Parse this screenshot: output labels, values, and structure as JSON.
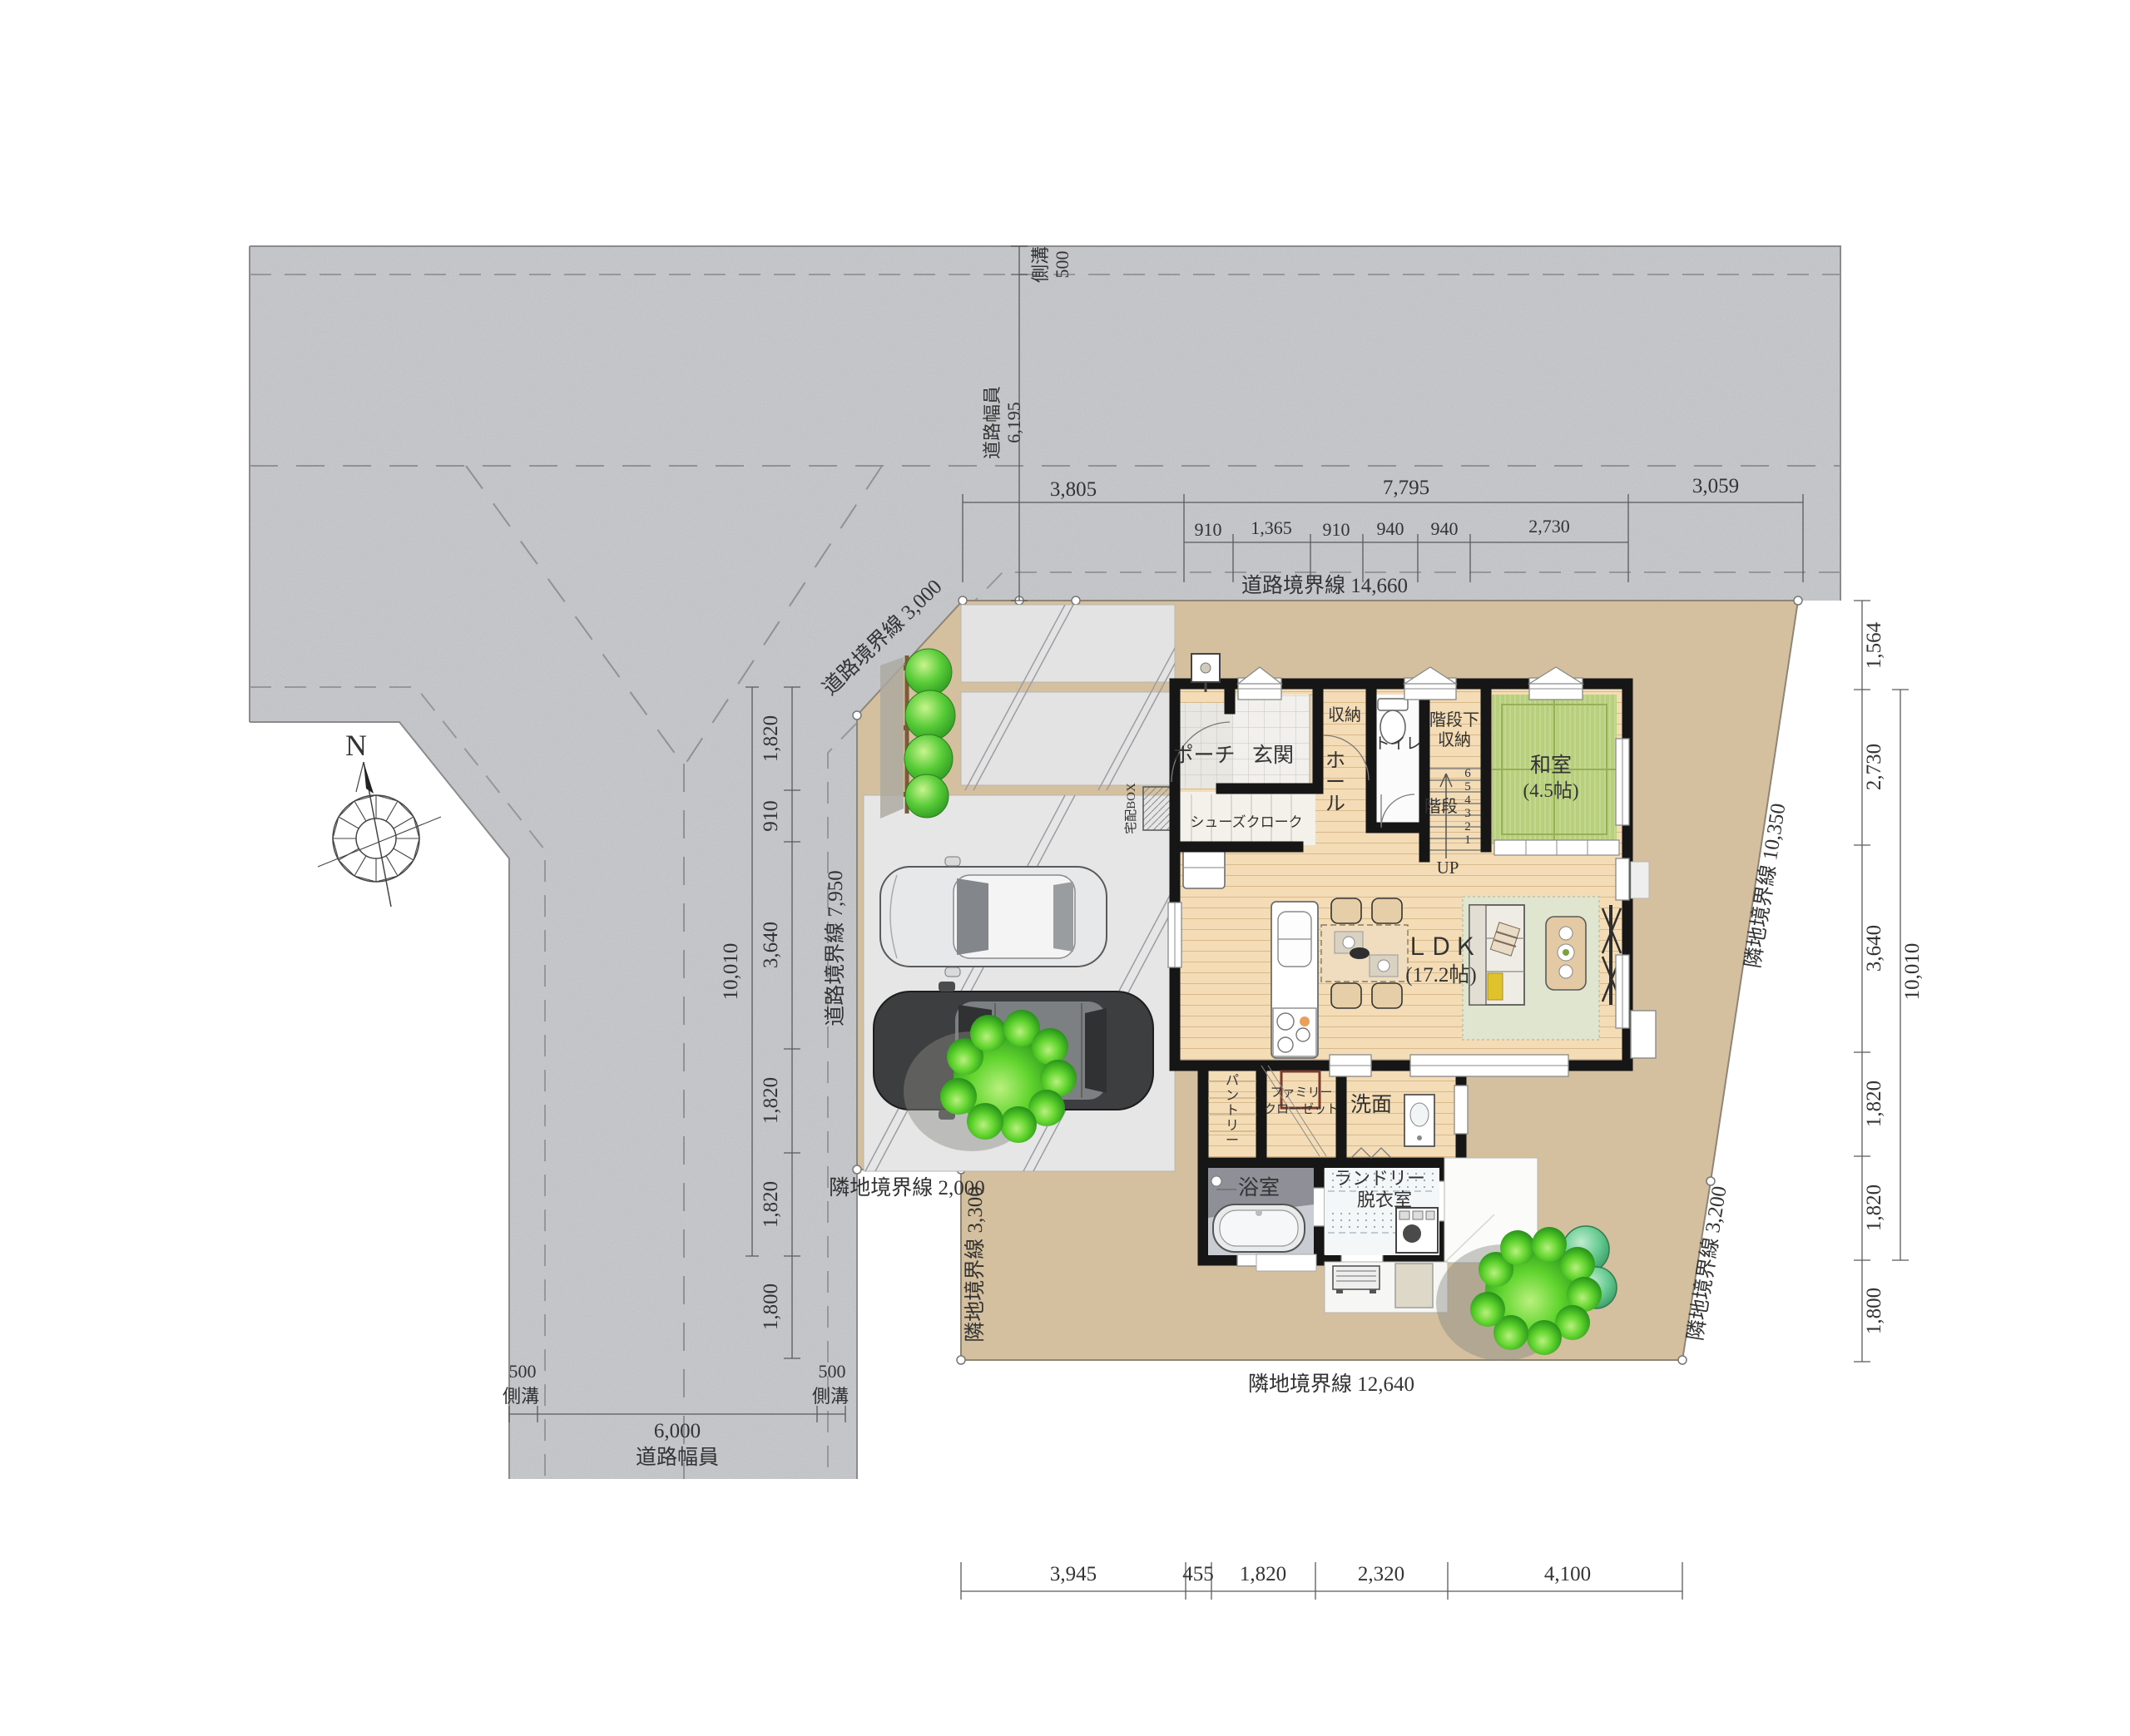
{
  "drawing": {
    "type": "residential site plan"
  },
  "compass": {
    "north": "N"
  },
  "road": {
    "top_gutter_label": "側溝",
    "top_gutter_value": "500",
    "top_width_label": "道路幅員",
    "top_width_value": "6,195",
    "bottom_width_label": "道路幅員",
    "bottom_width_value": "6,000",
    "bottom_left_gutter_value": "500",
    "bottom_left_gutter_label": "側溝",
    "bottom_right_gutter_value": "500",
    "bottom_right_gutter_label": "側溝"
  },
  "boundaries": {
    "road_north": "道路境界線 14,660",
    "road_corner": "道路境界線 3,000",
    "road_west": "道路境界線 7,950",
    "neighbor_step": "隣地境界線 2,000",
    "neighbor_west": "隣地境界線 3,300",
    "neighbor_east": "隣地境界線 10,350",
    "neighbor_southeast": "隣地境界線 3,200",
    "neighbor_south": "隣地境界線 12,640"
  },
  "dims": {
    "top_row1": [
      "3,805",
      "7,795",
      "3,059"
    ],
    "top_row2": [
      "910",
      "1,365",
      "910",
      "940",
      "940",
      "2,730"
    ],
    "left_col": [
      "1,820",
      "910",
      "3,640",
      "1,820",
      "1,820",
      "1,800"
    ],
    "left_total": "10,010",
    "right_col": [
      "1,564",
      "2,730",
      "3,640",
      "1,820",
      "1,820",
      "1,800"
    ],
    "right_total": "10,010",
    "bottom_row": [
      "3,945",
      "455",
      "1,820",
      "2,320",
      "4,100"
    ]
  },
  "rooms": {
    "porch": "ポーチ",
    "entrance": "玄関",
    "closet": "収納",
    "toilet": "トイレ",
    "under_stair_1": "階段下",
    "under_stair_2": "収納",
    "hall_chars": [
      "ホ",
      "ー",
      "ル"
    ],
    "stairs": "階段",
    "stairs_up": "UP",
    "stair_numbers": [
      "6",
      "5",
      "4",
      "3",
      "2",
      "1"
    ],
    "shoes_closet": "シューズクローク",
    "washitsu": "和室",
    "washitsu_size": "(4.5帖)",
    "ldk": "ＬＤＫ",
    "ldk_size": "(17.2帖)",
    "pantry_chars": [
      "パ",
      "ン",
      "ト",
      "リ",
      "ー"
    ],
    "family_closet_1": "ファミリー",
    "family_closet_2": "クローゼット",
    "washroom": "洗面",
    "bathroom": "浴室",
    "laundry_1": "ランドリー",
    "laundry_2": "脱衣室",
    "delivery_box": "宅配BOX"
  },
  "colors": {
    "road": "#c9cbce",
    "site": "#d4c09e",
    "wood": "#f3dcb6",
    "tatami": "#b8d07c",
    "tile": "#f1f0ec",
    "wall": "#161616",
    "concrete": "#e6e6e7",
    "tree": "#4cc42e"
  }
}
